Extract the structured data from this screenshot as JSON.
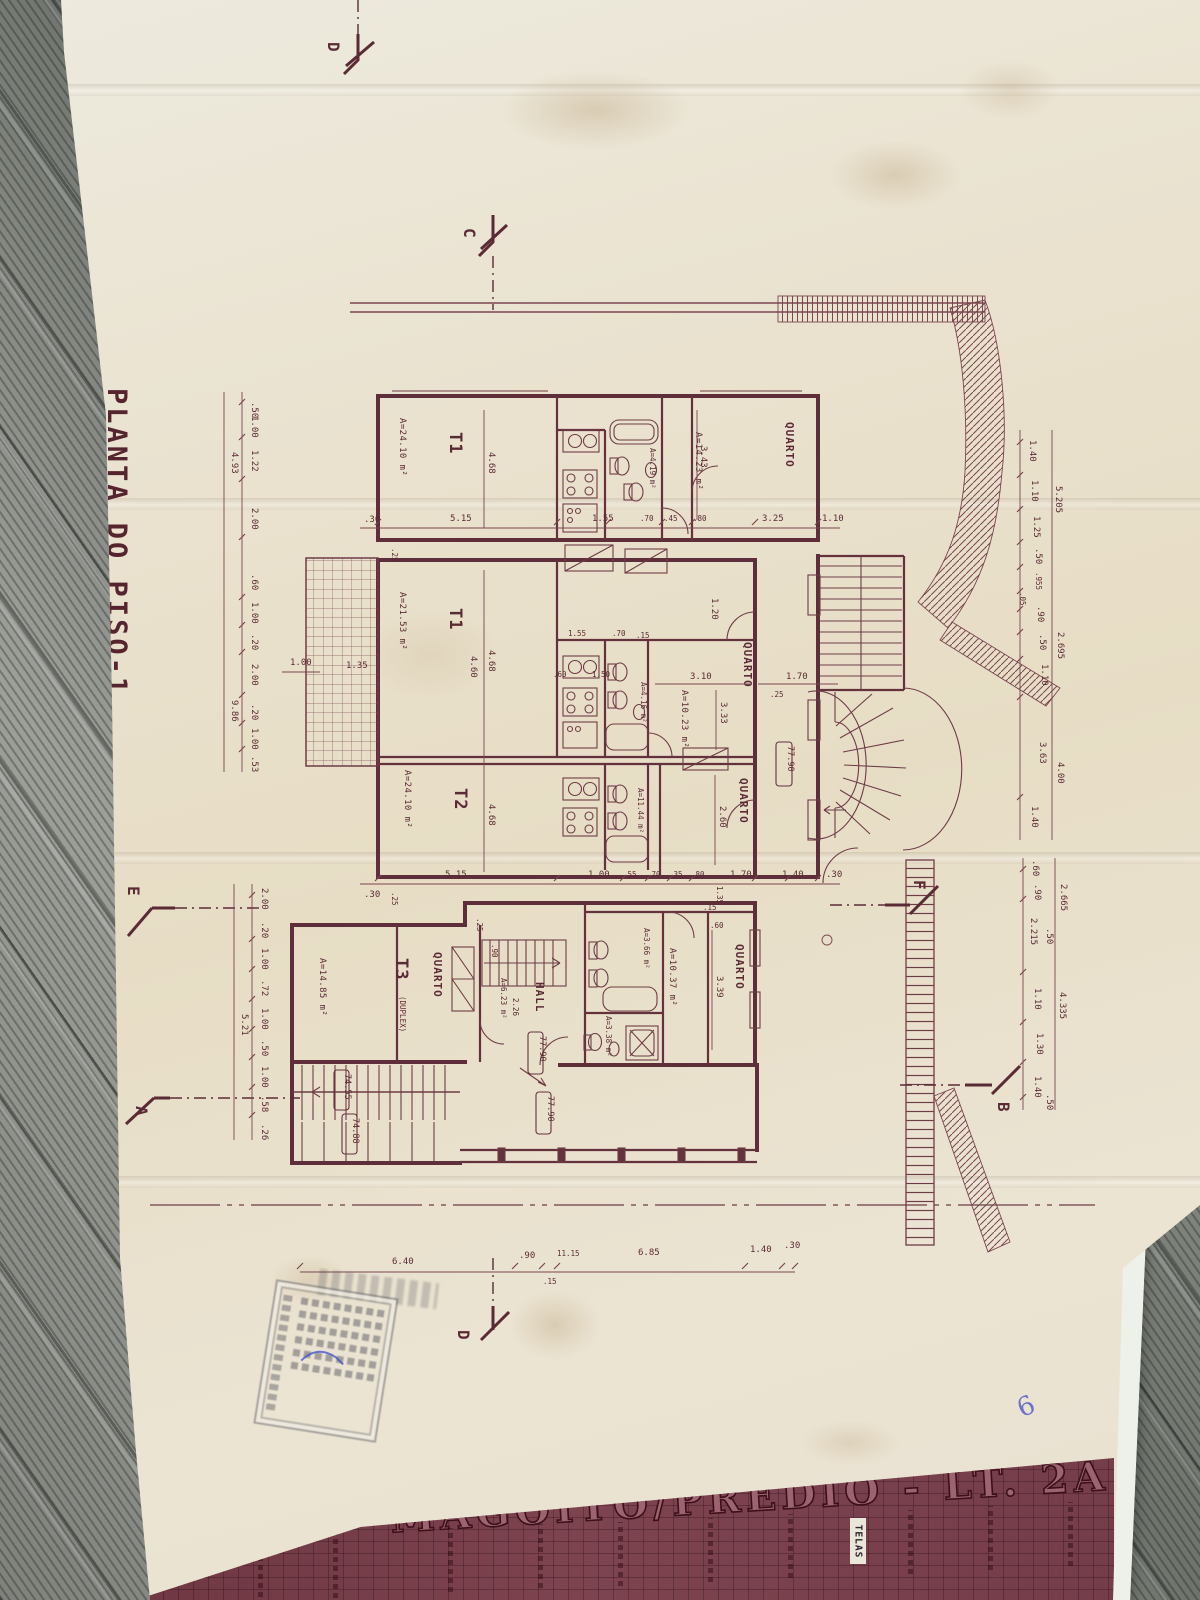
{
  "sheet": {
    "drawing_title": "PLANTA DO PISO-1",
    "ink_color": "#6b3a44",
    "paper_color": "#e9e1cf"
  },
  "title_block": {
    "project_title": "MAGOITO/PRÉDIO - LT. 2A",
    "white_tag": "TELAS",
    "band_color": "#7b4250"
  },
  "markers": {
    "d_top": "D",
    "c": "C",
    "e": "E",
    "a": "A",
    "f": "F",
    "b": "B",
    "d_bottom": "D"
  },
  "levels": {
    "right_7790": "77.90",
    "hall_7790_a": "77.90",
    "hall_7790_b": "77.90",
    "left_7455": "74.55",
    "left_7488": "74.88"
  },
  "rooms": {
    "t1a": {
      "name": "T1",
      "area": "A=24.10 m²"
    },
    "t1b": {
      "name": "T1",
      "area": "A=21.53 m²"
    },
    "t2": {
      "name": "T2",
      "area": "A=24.10 m²"
    },
    "t3": {
      "name": "T3",
      "suffix": "(DUPLEX)",
      "area": "A=14.85 m²"
    },
    "quarto_top": {
      "name": "QUARTO"
    },
    "quarto_mid": {
      "name": "QUARTO",
      "area": "A=10.23 m²"
    },
    "quarto_t2": {
      "name": "QUARTO"
    },
    "quarto_t3": {
      "name": "QUARTO"
    },
    "quarto_br": {
      "name": "QUARTO"
    },
    "q1037": {
      "area": "A=10.37 m²"
    },
    "hall": {
      "name": "HALL",
      "area": "A=6.23 m²",
      "depth": "2.26"
    },
    "bath_1423": {
      "area": "A=14.23 m²"
    },
    "bath_419": {
      "area": "A=4.19 m²"
    },
    "bath_416": {
      "area": "A=4.16 m²"
    },
    "bath_1144": {
      "area": "A=11.44 m²"
    },
    "bath_366": {
      "area": "A=3.66 m²"
    },
    "bath_338": {
      "area": "A=3.38 m²"
    }
  },
  "dims": {
    "upper_row": [
      ".30",
      "5.15",
      "1.55",
      ".70",
      ".45",
      ".80",
      "3.25",
      "1.10"
    ],
    "lower_row": [
      ".30",
      "5.15",
      "1.00",
      ".55",
      ".70",
      ".35",
      ".80",
      "1.35",
      "1.70",
      "1.40",
      ".30"
    ],
    "bottom_row": [
      "6.40",
      ".90",
      ".15",
      "11.15",
      "6.85",
      "1.40",
      ".30"
    ],
    "kitchen_upper": [
      "1.55",
      ".70",
      ".15"
    ],
    "kitchen_lower": [
      ".60",
      "1.50"
    ],
    "patio": [
      "1.00",
      "1.35"
    ],
    "left_chain": [
      ".50",
      "1.00",
      "1.22",
      "2.00",
      ".60",
      "1.00",
      ".20",
      "2.00",
      ".20",
      "1.00",
      ".53"
    ],
    "left_totals": [
      "4.93",
      "9.86"
    ],
    "left_lower_chain": [
      "2.00",
      ".20",
      "1.00",
      ".72",
      "1.00",
      ".50",
      "1.00",
      ".58",
      ".26"
    ],
    "left_lower_total": "5.21",
    "right_chain": [
      "1.40",
      "1.10",
      "1.25",
      ".50",
      ".955",
      ".05",
      ".90",
      ".50",
      "1.10",
      "3.63",
      "1.40"
    ],
    "right_totals": [
      "5.205",
      "2.695",
      "4.00"
    ],
    "far_right_chain": [
      ".60",
      ".90",
      "2.215",
      ".50",
      "1.10",
      "1.30",
      "1.40",
      ".50"
    ],
    "far_right_totals": [
      "2.665",
      "4.335"
    ],
    "interior": {
      "quarto_top_h": "3.43",
      "q1023_w": "3.10",
      "q1023_h": "3.33",
      "door_120": "1.20",
      "q_right_170": "1.70",
      "q260_h": "2.60",
      "q339_h": "3.39",
      "t1a_h": "4.68",
      "t1b_h": "4.68",
      "t1b_inner": "4.60",
      "t2_h": "4.68",
      "hall_w": "2.26",
      "step_90": ".90",
      "tick_25": ".25",
      "tick_15": ".15",
      "tick_35": ".35",
      "tick_60": ".60",
      "tick_30": ".30"
    }
  },
  "annotations": {
    "pen_mark": "6"
  }
}
